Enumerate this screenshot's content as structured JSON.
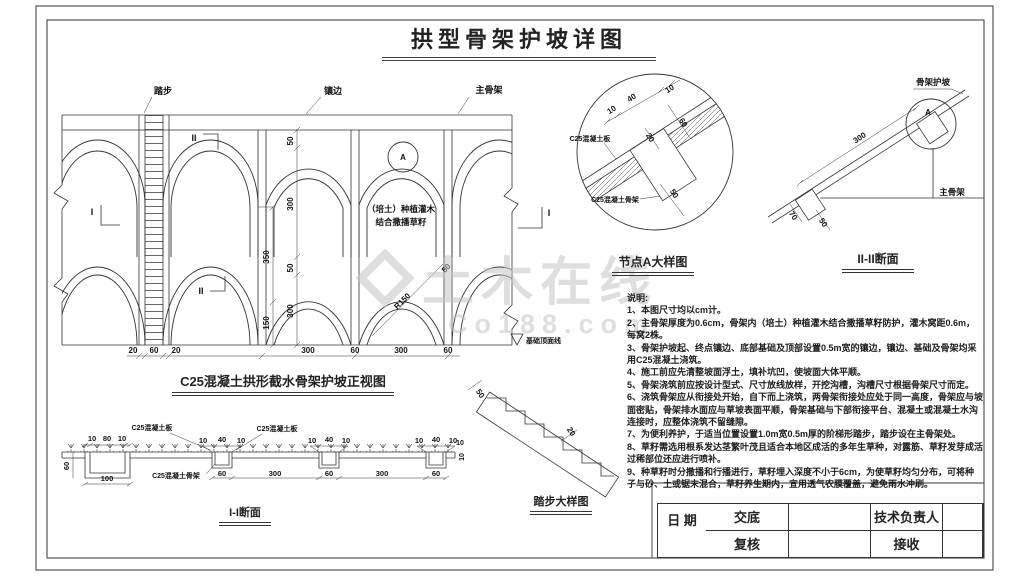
{
  "title": "拱型骨架护坡详图",
  "watermark": {
    "brand": "土木在线",
    "site": "Co188.com"
  },
  "colors": {
    "line": "#333333",
    "paper": "#ffffff",
    "watermark": "#c4c4c4"
  },
  "elevation": {
    "caption": "C25混凝土拱形截水骨架护坡正视图",
    "labels": {
      "steps": "踏步",
      "edge": "镶边",
      "main_frame": "主骨架",
      "planting1": "（培土）种植灌木",
      "planting2": "结合撒播草籽",
      "foundation": "基础顶面线",
      "radius": "R150",
      "node": "A",
      "sec_i": "I",
      "sec_ii": "II"
    },
    "dims": {
      "v50a": "50",
      "v300a": "300",
      "v50b": "50",
      "v300b": "300",
      "v350": "350",
      "v150": "150",
      "arc50": "50",
      "b20a": "20",
      "b60a": "60",
      "b20b": "20",
      "b300a": "300",
      "b60b": "60",
      "b300b": "300",
      "b60c": "60"
    }
  },
  "detail_a": {
    "caption": "节点A大样图",
    "labels": {
      "slab": "C25混凝土板",
      "frame": "C25混凝土骨架"
    },
    "dims": {
      "d10a": "10",
      "d40": "40",
      "d10b": "10",
      "d20": "20",
      "d60": "60",
      "d50": "50"
    }
  },
  "section_ii": {
    "caption": "II-II断面",
    "labels": {
      "slope": "骨架护坡",
      "main": "主骨架",
      "node": "A"
    },
    "dims": {
      "d300": "300",
      "d70": "70",
      "d50": "50"
    }
  },
  "section_i": {
    "caption": "I-I断面",
    "labels": {
      "slab_left": "C25混凝土板",
      "slab_right": "C25混凝土板",
      "frame": "C25混凝土骨架"
    },
    "dims": {
      "t10a": "10",
      "t80": "80",
      "t10b": "10",
      "l60": "60",
      "b100": "100",
      "a10": "10",
      "a40": "40",
      "a10b": "10",
      "c10": "10",
      "c40": "40",
      "c10b": "10",
      "e10": "10",
      "e40": "40",
      "e10b": "10",
      "b60a": "60",
      "b300a": "300",
      "b60b": "60",
      "b300b": "300",
      "b60c": "60",
      "r10": "10",
      "r10b": "10"
    }
  },
  "steps_detail": {
    "caption": "踏步大样图",
    "dims": {
      "d50": "50",
      "d20": "20"
    }
  },
  "notes": {
    "heading": "说明:",
    "items": [
      "1、本图尺寸均以cm计。",
      "2、主骨架厚度为0.6cm，骨架内（培土）种植灌木结合撒播草籽防护，灌木窝距0.6m，每窝2株。",
      "3、骨架护坡起、终点镶边、底部基础及顶部设置0.5m宽的镶边，镶边、基础及骨架均采用C25混凝土浇筑。",
      "4、施工前应先清整坡面浮土，填补坑凹，使坡面大体平顺。",
      "5、骨架浇筑前应按设计型式、尺寸放线放样，开挖沟槽，沟槽尺寸根据骨架尺寸而定。",
      "6、浇筑骨架应从衔接处开始，自下而上浇筑，两骨架衔接处应处于同一高度，骨架应与坡面密贴，骨架排水面应与草坡表面平顺，骨架基础与下部衔接平台、混凝土或混凝土水沟连接时，应整体浇筑不留缝隙。",
      "7、为便利养护，于适当位置设置1.0m宽0.5m厚的阶梯形踏步，踏步设在主骨架处。",
      "8、草籽需选用根系发达茎繁叶茂且适合本地区成活的多年生草种，对露筋、草籽发芽成活过稀部位还应进行喷补。",
      "9、种草籽时分撒播和行播进行，草籽埋入深度不小于6cm，为使草籽均匀分布，可将种子与砂、土或锯末混合，草籽养生期内，宜用透气农膜覆盖，避免雨水冲刷。"
    ]
  },
  "title_block": {
    "brief": "交底",
    "review": "复核",
    "tech_lead": "技术负责人",
    "receive": "接收",
    "date": "日 期"
  }
}
